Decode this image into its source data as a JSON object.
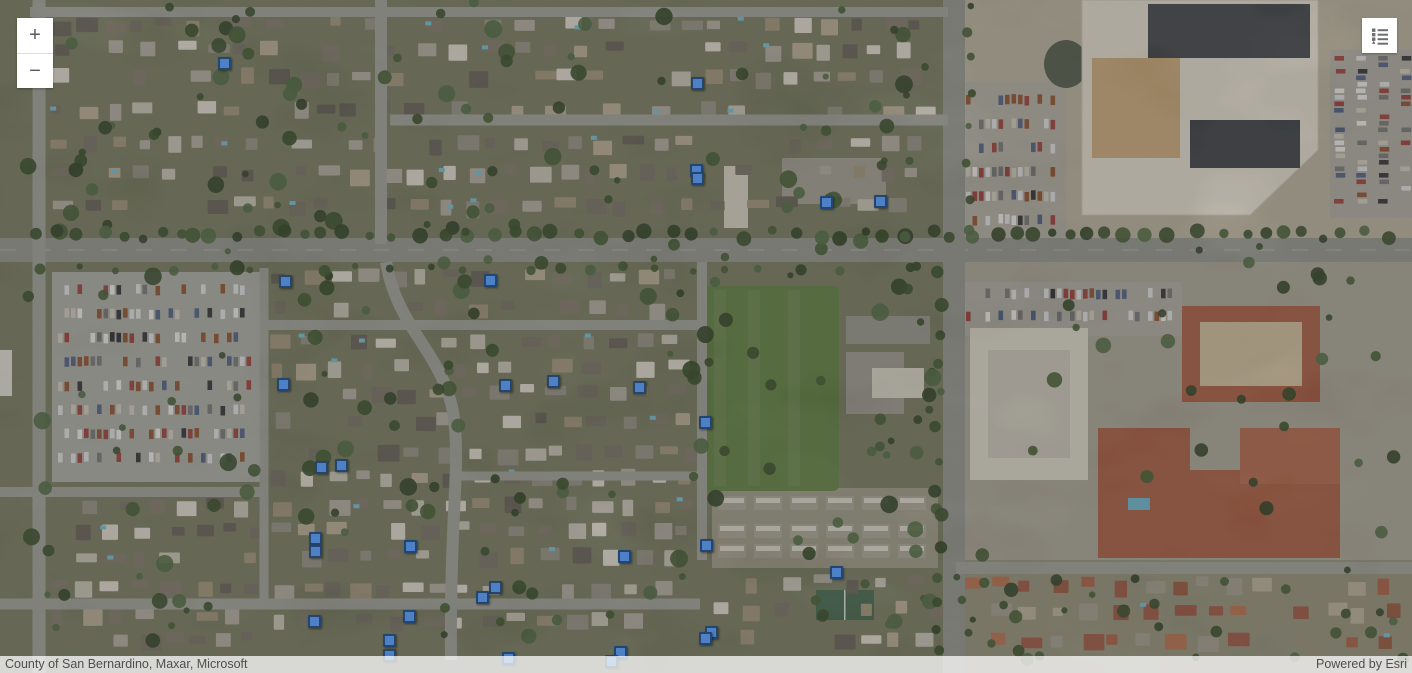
{
  "controls": {
    "zoom_in_label": "+",
    "zoom_out_label": "−",
    "legend_icon": "legend-list-icon"
  },
  "map": {
    "attribution": {
      "sources": "County of San Bernardino, Maxar, Microsoft",
      "powered_by": "Powered by Esri"
    },
    "marker_style": {
      "fill": "#4d80c4",
      "stroke": "#24456e",
      "size": 13
    },
    "markers": [
      {
        "x": 224,
        "y": 63
      },
      {
        "x": 697,
        "y": 83
      },
      {
        "x": 696,
        "y": 170
      },
      {
        "x": 697,
        "y": 178
      },
      {
        "x": 826,
        "y": 202
      },
      {
        "x": 880,
        "y": 201
      },
      {
        "x": 285,
        "y": 281
      },
      {
        "x": 490,
        "y": 280
      },
      {
        "x": 283,
        "y": 384
      },
      {
        "x": 505,
        "y": 385
      },
      {
        "x": 553,
        "y": 381
      },
      {
        "x": 639,
        "y": 387
      },
      {
        "x": 705,
        "y": 422
      },
      {
        "x": 321,
        "y": 467
      },
      {
        "x": 341,
        "y": 465
      },
      {
        "x": 315,
        "y": 538
      },
      {
        "x": 315,
        "y": 551
      },
      {
        "x": 410,
        "y": 546
      },
      {
        "x": 624,
        "y": 556
      },
      {
        "x": 706,
        "y": 545
      },
      {
        "x": 836,
        "y": 572
      },
      {
        "x": 495,
        "y": 587
      },
      {
        "x": 482,
        "y": 597
      },
      {
        "x": 314,
        "y": 621
      },
      {
        "x": 409,
        "y": 616
      },
      {
        "x": 389,
        "y": 640
      },
      {
        "x": 389,
        "y": 655
      },
      {
        "x": 508,
        "y": 658
      },
      {
        "x": 620,
        "y": 652
      },
      {
        "x": 611,
        "y": 661
      },
      {
        "x": 711,
        "y": 632
      },
      {
        "x": 705,
        "y": 638
      }
    ]
  }
}
